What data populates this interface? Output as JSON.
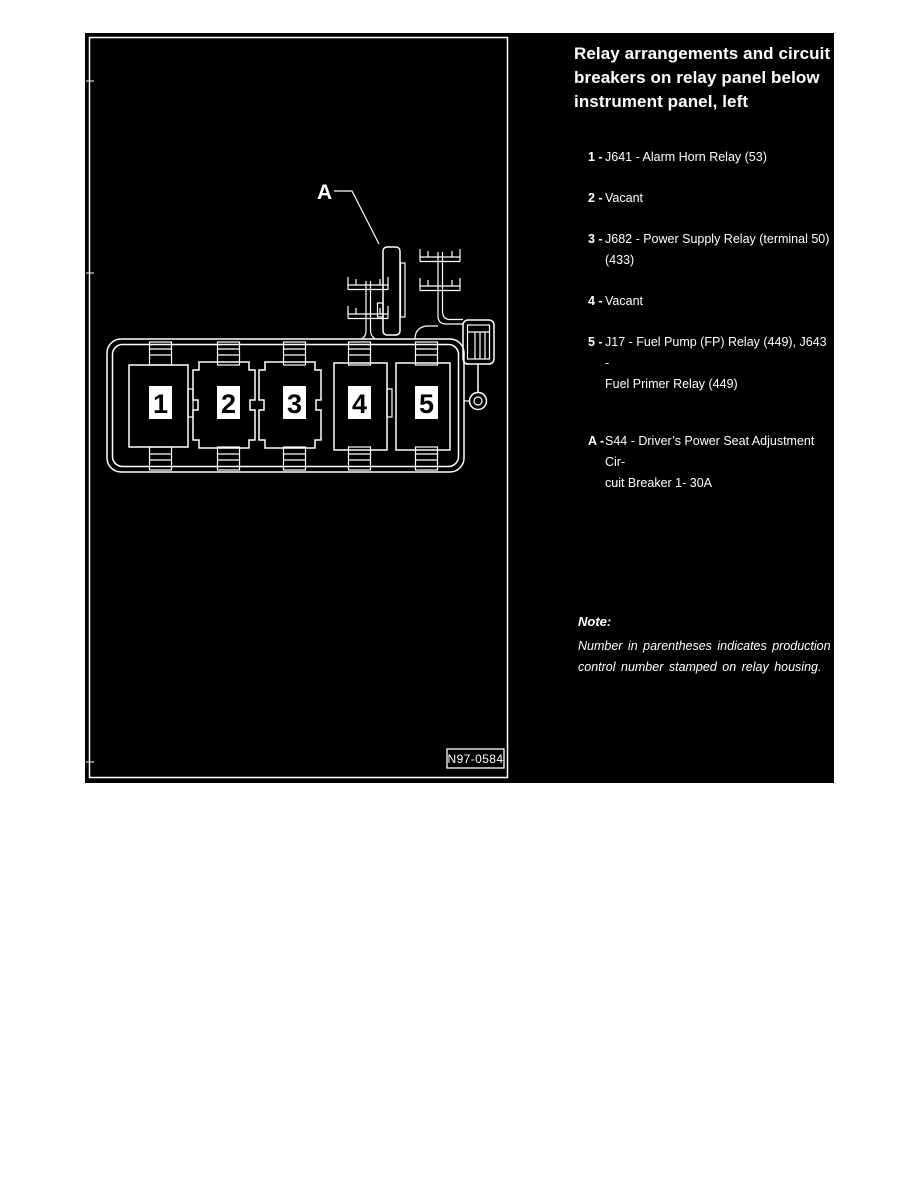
{
  "colors": {
    "page_background": "#ffffff",
    "panel_background": "#000000",
    "line_and_text": "#ffffff"
  },
  "figure": {
    "callout_label": "A",
    "figure_number": "N97-0584",
    "relay_positions": [
      "1",
      "2",
      "3",
      "4",
      "5"
    ]
  },
  "legend": {
    "title_lines": [
      "Relay arrangements and circuit",
      "breakers on relay panel below",
      "instrument panel, left"
    ],
    "items": [
      {
        "marker": "1 -",
        "lines": [
          "J641 - Alarm Horn Relay (53)"
        ]
      },
      {
        "marker": "2 -",
        "lines": [
          "Vacant"
        ]
      },
      {
        "marker": "3 -",
        "lines": [
          "J682 - Power Supply Relay (terminal 50)",
          "(433)"
        ]
      },
      {
        "marker": "4 -",
        "lines": [
          "Vacant"
        ]
      },
      {
        "marker": "5 -",
        "lines": [
          "J17 - Fuel Pump (FP) Relay (449), J643 -",
          "Fuel Primer Relay (449)"
        ]
      },
      {
        "marker": "A -",
        "lines": [
          "S44 - Driver’s Power Seat Adjustment Cir-",
          "cuit Breaker 1- 30A"
        ]
      }
    ],
    "note_label": "Note:",
    "note_lines": [
      "Number in parentheses indicates production",
      "control number stamped on relay housing."
    ]
  }
}
